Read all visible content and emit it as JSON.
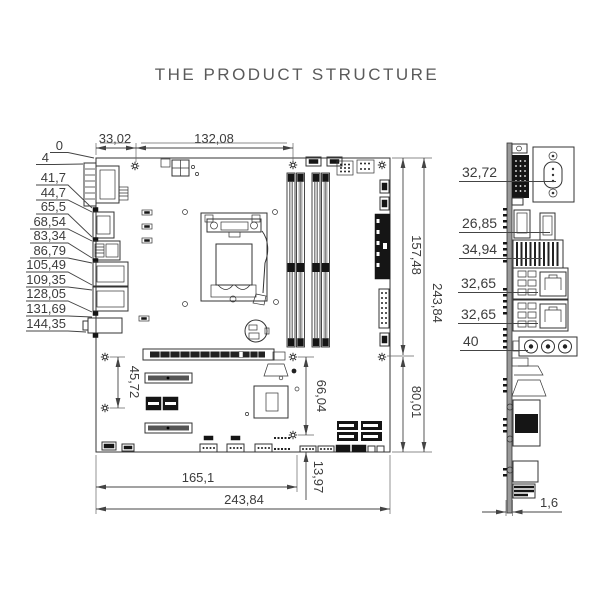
{
  "title": "THE PRODUCT STRUCTURE",
  "dims": {
    "top": [
      "33,02",
      "132,08"
    ],
    "left": [
      "0",
      "4",
      "41,7",
      "44,7",
      "65,5",
      "68,54",
      "83,34",
      "86,79",
      "105,49",
      "109,35",
      "128,05",
      "131,69",
      "144,35"
    ],
    "right": {
      "upper": "157,48",
      "full": "243,84",
      "lower": "80,01"
    },
    "bottom": {
      "inner": "165,1",
      "full": "243,84",
      "offset": "13,97"
    },
    "interior": {
      "slot_holes": "45,72",
      "center_holes": "66,04"
    }
  },
  "side": {
    "dims": [
      "32,72",
      "26,85",
      "34,94",
      "32,65",
      "32,65",
      "40"
    ],
    "thickness": "1,6"
  }
}
